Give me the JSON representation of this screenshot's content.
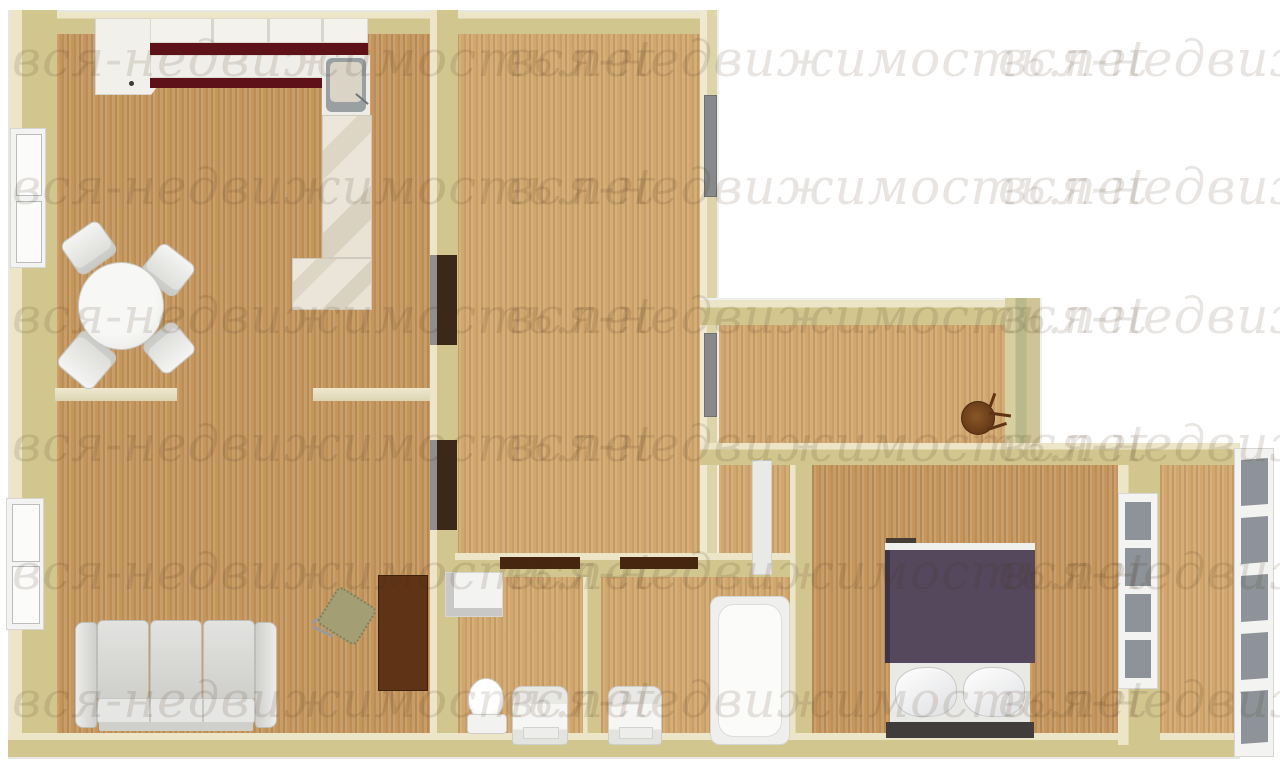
{
  "image_type": "3d-apartment-floor-plan-top-view",
  "watermark": {
    "text": "вся-недвижимость.net",
    "font_size": 50,
    "rows_y": [
      30,
      158,
      287,
      415,
      543,
      671
    ],
    "cols_x": [
      12,
      505,
      998
    ],
    "color": "rgba(70,45,25,0.13)"
  },
  "colors": {
    "wall": "#d2c68f",
    "wall-light": "#ece5c8",
    "wall-green": "#b9b98c",
    "wood-dark": "#c5965c",
    "wood-light": "#d2a76d",
    "maroon": "#5f1119",
    "marble": "#e7e2d4",
    "fixture": "#f3f3f1",
    "door-brown": "#5e3316",
    "door-dark": "#3c2818",
    "door-gray": "#87898b",
    "duvet-purple": "#55485c",
    "headboard": "#413d3a",
    "chair-olive": "#a49e74",
    "glass": "#8d9398",
    "stand-brown": "#7a4a22",
    "watermark": "rgba(70,45,25,0.13)"
  },
  "legend": {
    "rooms": [
      "living-dining-room",
      "kitchen-area",
      "middle-room",
      "corridor",
      "vestibule",
      "wc",
      "bathroom",
      "bedroom",
      "balcony"
    ],
    "fixtures": [
      "kitchen-corner-cabinet",
      "kitchen-wall-cabinets",
      "kitchen-counter",
      "kitchen-sink",
      "marble-counter",
      "dining-table",
      "dining-chair",
      "sofa",
      "office-chair",
      "interior-door",
      "entry-door",
      "window",
      "washing-machine",
      "toilet",
      "sink-vanity",
      "bathtub",
      "double-bed",
      "pillow",
      "coat-stand",
      "balcony-window"
    ]
  }
}
